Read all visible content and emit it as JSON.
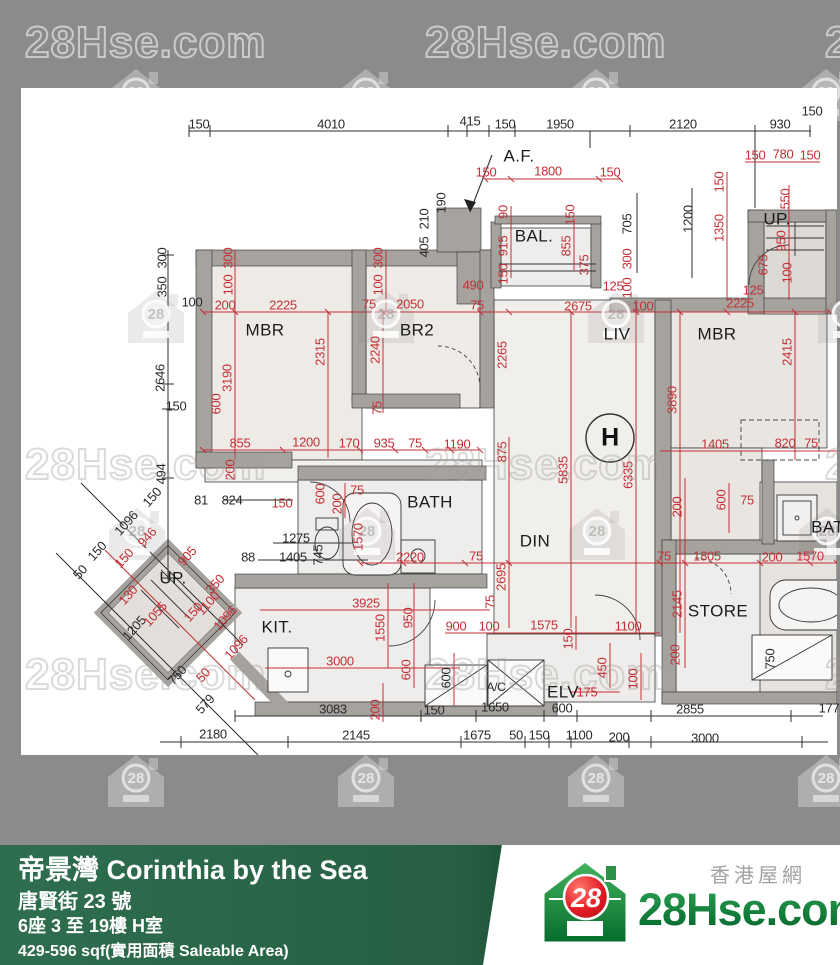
{
  "colors": {
    "background_gray": "#8b8b8b",
    "dim_red": "#c42f35",
    "dim_black": "#2a2a2a",
    "footer_green": "#2e6e4e",
    "footer_green_dark": "#1c5036",
    "logo_green": "#0d8a3a",
    "logo_red": "#e8252b"
  },
  "watermark": {
    "text": "28Hse.com",
    "house_number": "28",
    "text_rows": [
      {
        "y": 18,
        "xs": [
          25,
          425,
          825
        ],
        "on": "gray"
      },
      {
        "y": 440,
        "xs": [
          25,
          425,
          825
        ],
        "on": "white"
      },
      {
        "y": 650,
        "xs": [
          25,
          425,
          825
        ],
        "on": "white"
      }
    ],
    "house_rows": [
      {
        "y": 66,
        "xs": [
          103,
          333,
          563,
          793
        ],
        "on": "gray"
      },
      {
        "y": 288,
        "xs": [
          123,
          353,
          583,
          813
        ],
        "on": "white"
      },
      {
        "y": 505,
        "xs": [
          104,
          334,
          564,
          794
        ],
        "on": "white"
      },
      {
        "y": 752,
        "xs": [
          103,
          333,
          563,
          793
        ],
        "on": "gray"
      }
    ]
  },
  "floorplan": {
    "labels": [
      {
        "t": "150",
        "x": 199,
        "y": 124,
        "c": "k"
      },
      {
        "t": "4010",
        "x": 331,
        "y": 124,
        "c": "k"
      },
      {
        "t": "415",
        "x": 470,
        "y": 121,
        "c": "k"
      },
      {
        "t": "150",
        "x": 505,
        "y": 124,
        "c": "k"
      },
      {
        "t": "1950",
        "x": 560,
        "y": 124,
        "c": "k"
      },
      {
        "t": "2120",
        "x": 683,
        "y": 124,
        "c": "k"
      },
      {
        "t": "930",
        "x": 780,
        "y": 124,
        "c": "k"
      },
      {
        "t": "150",
        "x": 812,
        "y": 111,
        "c": "k"
      },
      {
        "t": "A.F.",
        "x": 519,
        "y": 156,
        "c": "k",
        "s": "room"
      },
      {
        "t": "190",
        "x": 441,
        "y": 203,
        "c": "k",
        "r": -90
      },
      {
        "t": "210",
        "x": 424,
        "y": 219,
        "c": "k",
        "r": -90
      },
      {
        "t": "405",
        "x": 424,
        "y": 247,
        "c": "k",
        "r": -90
      },
      {
        "t": "705",
        "x": 627,
        "y": 224,
        "c": "k",
        "r": -90
      },
      {
        "t": "1200",
        "x": 688,
        "y": 219,
        "c": "k",
        "r": -90
      },
      {
        "t": "300",
        "x": 162,
        "y": 258,
        "c": "k",
        "r": -90
      },
      {
        "t": "350",
        "x": 162,
        "y": 287,
        "c": "k",
        "r": -90
      },
      {
        "t": "100",
        "x": 192,
        "y": 302,
        "c": "k"
      },
      {
        "t": "2646",
        "x": 160,
        "y": 378,
        "c": "k",
        "r": -90
      },
      {
        "t": "494",
        "x": 161,
        "y": 474,
        "c": "k",
        "r": -90
      },
      {
        "t": "150",
        "x": 152,
        "y": 497,
        "c": "k",
        "r": -48
      },
      {
        "t": "1096",
        "x": 126,
        "y": 523,
        "c": "k",
        "r": -48
      },
      {
        "t": "150",
        "x": 97,
        "y": 551,
        "c": "k",
        "r": -48
      },
      {
        "t": "50",
        "x": 80,
        "y": 572,
        "c": "k",
        "r": -48
      },
      {
        "t": "1205",
        "x": 134,
        "y": 628,
        "c": "k",
        "r": -48
      },
      {
        "t": "750",
        "x": 177,
        "y": 675,
        "c": "k",
        "r": -48
      },
      {
        "t": "579",
        "x": 205,
        "y": 704,
        "c": "k",
        "r": -48
      },
      {
        "t": "81",
        "x": 201,
        "y": 500,
        "c": "k"
      },
      {
        "t": "824",
        "x": 232,
        "y": 500,
        "c": "k"
      },
      {
        "t": "88",
        "x": 248,
        "y": 557,
        "c": "k"
      },
      {
        "t": "1275",
        "x": 296,
        "y": 538,
        "c": "k"
      },
      {
        "t": "1405",
        "x": 293,
        "y": 557,
        "c": "k"
      },
      {
        "t": "745",
        "x": 318,
        "y": 555,
        "c": "k",
        "r": -90
      },
      {
        "t": "150",
        "x": 176,
        "y": 406,
        "c": "k"
      },
      {
        "t": "750",
        "x": 770,
        "y": 659,
        "c": "k",
        "r": -90
      },
      {
        "t": "600",
        "x": 446,
        "y": 678,
        "c": "k",
        "r": -90
      },
      {
        "t": "3083",
        "x": 333,
        "y": 709,
        "c": "k"
      },
      {
        "t": "150",
        "x": 434,
        "y": 710,
        "c": "k"
      },
      {
        "t": "1650",
        "x": 495,
        "y": 707,
        "c": "k"
      },
      {
        "t": "600",
        "x": 562,
        "y": 708,
        "c": "k"
      },
      {
        "t": "2855",
        "x": 690,
        "y": 709,
        "c": "k"
      },
      {
        "t": "177",
        "x": 829,
        "y": 708,
        "c": "k"
      },
      {
        "t": "2180",
        "x": 213,
        "y": 734,
        "c": "k"
      },
      {
        "t": "2145",
        "x": 356,
        "y": 735,
        "c": "k"
      },
      {
        "t": "1675",
        "x": 477,
        "y": 735,
        "c": "k"
      },
      {
        "t": "50",
        "x": 516,
        "y": 735,
        "c": "k"
      },
      {
        "t": "150",
        "x": 539,
        "y": 735,
        "c": "k"
      },
      {
        "t": "1100",
        "x": 579,
        "y": 735,
        "c": "k"
      },
      {
        "t": "200",
        "x": 619,
        "y": 737,
        "c": "k"
      },
      {
        "t": "3000",
        "x": 705,
        "y": 738,
        "c": "k"
      },
      {
        "t": "150",
        "x": 486,
        "y": 172,
        "c": "r"
      },
      {
        "t": "1800",
        "x": 548,
        "y": 171,
        "c": "r"
      },
      {
        "t": "150",
        "x": 610,
        "y": 172,
        "c": "r"
      },
      {
        "t": "90",
        "x": 503,
        "y": 212,
        "c": "r",
        "r": -90
      },
      {
        "t": "915",
        "x": 503,
        "y": 246,
        "c": "r",
        "r": -90
      },
      {
        "t": "150",
        "x": 503,
        "y": 274,
        "c": "r",
        "r": -90
      },
      {
        "t": "150",
        "x": 570,
        "y": 215,
        "c": "r",
        "r": -90
      },
      {
        "t": "855",
        "x": 566,
        "y": 246,
        "c": "r",
        "r": -90
      },
      {
        "t": "375",
        "x": 584,
        "y": 265,
        "c": "r",
        "r": -90
      },
      {
        "t": "125",
        "x": 613,
        "y": 286,
        "c": "r"
      },
      {
        "t": "300",
        "x": 627,
        "y": 259,
        "c": "r",
        "r": -90
      },
      {
        "t": "100",
        "x": 627,
        "y": 288,
        "c": "r",
        "r": -90
      },
      {
        "t": "490",
        "x": 473,
        "y": 285,
        "c": "r"
      },
      {
        "t": "75",
        "x": 477,
        "y": 305,
        "c": "r"
      },
      {
        "t": "150",
        "x": 719,
        "y": 182,
        "c": "r",
        "r": -90
      },
      {
        "t": "1350",
        "x": 719,
        "y": 228,
        "c": "r",
        "r": -90
      },
      {
        "t": "550",
        "x": 785,
        "y": 199,
        "c": "r",
        "r": -90
      },
      {
        "t": "950",
        "x": 781,
        "y": 241,
        "c": "r",
        "r": -90
      },
      {
        "t": "675",
        "x": 763,
        "y": 265,
        "c": "r",
        "r": -90
      },
      {
        "t": "100",
        "x": 787,
        "y": 273,
        "c": "r",
        "r": -90
      },
      {
        "t": "125",
        "x": 753,
        "y": 290,
        "c": "r"
      },
      {
        "t": "150",
        "x": 755,
        "y": 155,
        "c": "r"
      },
      {
        "t": "780",
        "x": 783,
        "y": 154,
        "c": "r"
      },
      {
        "t": "150",
        "x": 810,
        "y": 155,
        "c": "r"
      },
      {
        "t": "2225",
        "x": 740,
        "y": 303,
        "c": "r"
      },
      {
        "t": "300",
        "x": 228,
        "y": 258,
        "c": "r",
        "r": -90
      },
      {
        "t": "100",
        "x": 228,
        "y": 285,
        "c": "r",
        "r": -90
      },
      {
        "t": "300",
        "x": 378,
        "y": 258,
        "c": "r",
        "r": -90
      },
      {
        "t": "100",
        "x": 378,
        "y": 285,
        "c": "r",
        "r": -90
      },
      {
        "t": "200",
        "x": 225,
        "y": 305,
        "c": "r"
      },
      {
        "t": "2225",
        "x": 283,
        "y": 305,
        "c": "r"
      },
      {
        "t": "75",
        "x": 369,
        "y": 304,
        "c": "r"
      },
      {
        "t": "2050",
        "x": 410,
        "y": 304,
        "c": "r"
      },
      {
        "t": "2675",
        "x": 578,
        "y": 306,
        "c": "r"
      },
      {
        "t": "100",
        "x": 643,
        "y": 306,
        "c": "r"
      },
      {
        "t": "3190",
        "x": 227,
        "y": 378,
        "c": "r",
        "r": -90
      },
      {
        "t": "2315",
        "x": 320,
        "y": 352,
        "c": "r",
        "r": -90
      },
      {
        "t": "2240",
        "x": 375,
        "y": 350,
        "c": "r",
        "r": -90
      },
      {
        "t": "75",
        "x": 377,
        "y": 408,
        "c": "r",
        "r": -90
      },
      {
        "t": "2265",
        "x": 502,
        "y": 355,
        "c": "r",
        "r": -90
      },
      {
        "t": "2415",
        "x": 787,
        "y": 352,
        "c": "r",
        "r": -90
      },
      {
        "t": "3890",
        "x": 672,
        "y": 400,
        "c": "r",
        "r": -90
      },
      {
        "t": "2695",
        "x": 501,
        "y": 577,
        "c": "r",
        "r": -90
      },
      {
        "t": "5835",
        "x": 563,
        "y": 470,
        "c": "r",
        "r": -90
      },
      {
        "t": "6335",
        "x": 628,
        "y": 475,
        "c": "r",
        "r": -90
      },
      {
        "t": "855",
        "x": 240,
        "y": 443,
        "c": "r"
      },
      {
        "t": "1200",
        "x": 306,
        "y": 442,
        "c": "r"
      },
      {
        "t": "170",
        "x": 349,
        "y": 443,
        "c": "r"
      },
      {
        "t": "935",
        "x": 384,
        "y": 443,
        "c": "r"
      },
      {
        "t": "75",
        "x": 415,
        "y": 443,
        "c": "r"
      },
      {
        "t": "1190",
        "x": 457,
        "y": 444,
        "c": "r"
      },
      {
        "t": "875",
        "x": 502,
        "y": 452,
        "c": "r",
        "r": -90
      },
      {
        "t": "600",
        "x": 216,
        "y": 404,
        "c": "r",
        "r": -90
      },
      {
        "t": "200",
        "x": 230,
        "y": 470,
        "c": "r",
        "r": -90
      },
      {
        "t": "150",
        "x": 282,
        "y": 503,
        "c": "r"
      },
      {
        "t": "600",
        "x": 320,
        "y": 494,
        "c": "r",
        "r": -90
      },
      {
        "t": "200",
        "x": 337,
        "y": 504,
        "c": "r",
        "r": -90
      },
      {
        "t": "75",
        "x": 357,
        "y": 490,
        "c": "r"
      },
      {
        "t": "1570",
        "x": 358,
        "y": 537,
        "c": "r",
        "r": -90
      },
      {
        "t": "2220",
        "x": 410,
        "y": 557,
        "c": "r"
      },
      {
        "t": "75",
        "x": 476,
        "y": 556,
        "c": "r"
      },
      {
        "t": "1405",
        "x": 715,
        "y": 444,
        "c": "r"
      },
      {
        "t": "820",
        "x": 785,
        "y": 443,
        "c": "r"
      },
      {
        "t": "75",
        "x": 811,
        "y": 443,
        "c": "r"
      },
      {
        "t": "200",
        "x": 677,
        "y": 507,
        "c": "r",
        "r": -90
      },
      {
        "t": "600",
        "x": 721,
        "y": 500,
        "c": "r",
        "r": -90
      },
      {
        "t": "75",
        "x": 747,
        "y": 500,
        "c": "r"
      },
      {
        "t": "75",
        "x": 664,
        "y": 556,
        "c": "r"
      },
      {
        "t": "1805",
        "x": 707,
        "y": 556,
        "c": "r"
      },
      {
        "t": "200",
        "x": 772,
        "y": 557,
        "c": "r"
      },
      {
        "t": "1570",
        "x": 810,
        "y": 556,
        "c": "r"
      },
      {
        "t": "2145",
        "x": 677,
        "y": 604,
        "c": "r",
        "r": -90
      },
      {
        "t": "200",
        "x": 675,
        "y": 655,
        "c": "r",
        "r": -90
      },
      {
        "t": "946",
        "x": 147,
        "y": 537,
        "c": "r",
        "r": -48
      },
      {
        "t": "150",
        "x": 124,
        "y": 558,
        "c": "r",
        "r": -48
      },
      {
        "t": "905",
        "x": 187,
        "y": 556,
        "c": "r",
        "r": -48
      },
      {
        "t": "350",
        "x": 215,
        "y": 584,
        "c": "r",
        "r": -48
      },
      {
        "t": "1100",
        "x": 208,
        "y": 603,
        "c": "r",
        "r": -48
      },
      {
        "t": "150",
        "x": 193,
        "y": 612,
        "c": "r",
        "r": -48
      },
      {
        "t": "1096",
        "x": 225,
        "y": 618,
        "c": "r",
        "r": -48
      },
      {
        "t": "1096",
        "x": 236,
        "y": 647,
        "c": "r",
        "r": -48
      },
      {
        "t": "130",
        "x": 128,
        "y": 595,
        "c": "r",
        "r": -48
      },
      {
        "t": "1055",
        "x": 155,
        "y": 614,
        "c": "r",
        "r": -48
      },
      {
        "t": "50",
        "x": 203,
        "y": 675,
        "c": "r",
        "r": -48
      },
      {
        "t": "3925",
        "x": 366,
        "y": 603,
        "c": "r"
      },
      {
        "t": "1550",
        "x": 380,
        "y": 628,
        "c": "r",
        "r": -90
      },
      {
        "t": "950",
        "x": 408,
        "y": 618,
        "c": "r",
        "r": -90
      },
      {
        "t": "600",
        "x": 406,
        "y": 670,
        "c": "r",
        "r": -90
      },
      {
        "t": "3000",
        "x": 340,
        "y": 661,
        "c": "r"
      },
      {
        "t": "900",
        "x": 456,
        "y": 626,
        "c": "r"
      },
      {
        "t": "100",
        "x": 489,
        "y": 626,
        "c": "r"
      },
      {
        "t": "1575",
        "x": 544,
        "y": 625,
        "c": "r"
      },
      {
        "t": "150",
        "x": 568,
        "y": 639,
        "c": "r",
        "r": -90
      },
      {
        "t": "1100",
        "x": 628,
        "y": 626,
        "c": "r"
      },
      {
        "t": "75",
        "x": 490,
        "y": 602,
        "c": "r",
        "r": -90
      },
      {
        "t": "200",
        "x": 375,
        "y": 710,
        "c": "r",
        "r": -90
      },
      {
        "t": "450",
        "x": 602,
        "y": 668,
        "c": "r",
        "r": -90
      },
      {
        "t": "100",
        "x": 633,
        "y": 679,
        "c": "r",
        "r": -90
      },
      {
        "t": "175",
        "x": 587,
        "y": 692,
        "c": "r"
      },
      {
        "t": "MBR",
        "x": 265,
        "y": 330,
        "c": "k",
        "s": "room"
      },
      {
        "t": "BR2",
        "x": 417,
        "y": 330,
        "c": "k",
        "s": "room"
      },
      {
        "t": "LIV",
        "x": 617,
        "y": 334,
        "c": "k",
        "s": "room"
      },
      {
        "t": "MBR",
        "x": 717,
        "y": 334,
        "c": "k",
        "s": "room"
      },
      {
        "t": "BAL.",
        "x": 534,
        "y": 236,
        "c": "k",
        "s": "room"
      },
      {
        "t": "UP.",
        "x": 777,
        "y": 219,
        "c": "k",
        "s": "room"
      },
      {
        "t": "UP.",
        "x": 173,
        "y": 578,
        "c": "k",
        "s": "room"
      },
      {
        "t": "KIT.",
        "x": 277,
        "y": 627,
        "c": "k",
        "s": "room"
      },
      {
        "t": "BATH",
        "x": 430,
        "y": 502,
        "c": "k",
        "s": "room"
      },
      {
        "t": "DIN",
        "x": 535,
        "y": 541,
        "c": "k",
        "s": "room"
      },
      {
        "t": "STORE",
        "x": 718,
        "y": 611,
        "c": "k",
        "s": "room"
      },
      {
        "t": "A/C",
        "x": 496,
        "y": 687,
        "c": "k",
        "s": "med"
      },
      {
        "t": "ELV",
        "x": 563,
        "y": 692,
        "c": "k",
        "s": "room"
      },
      {
        "t": "BATH",
        "x": 834,
        "y": 527,
        "c": "k",
        "s": "room"
      },
      {
        "t": "H",
        "x": 610,
        "y": 438,
        "c": "k",
        "s": "big"
      }
    ]
  },
  "footer": {
    "title": "帝景灣 Corinthia by the Sea",
    "address": "唐賢街 23 號",
    "block_floor": "6座 3 至 19樓 H室",
    "area": "429-596 sqf(實用面積 Saleable Area)"
  },
  "logo": {
    "site": "28Hse.com",
    "chinese": "香港屋網",
    "number": "28"
  }
}
